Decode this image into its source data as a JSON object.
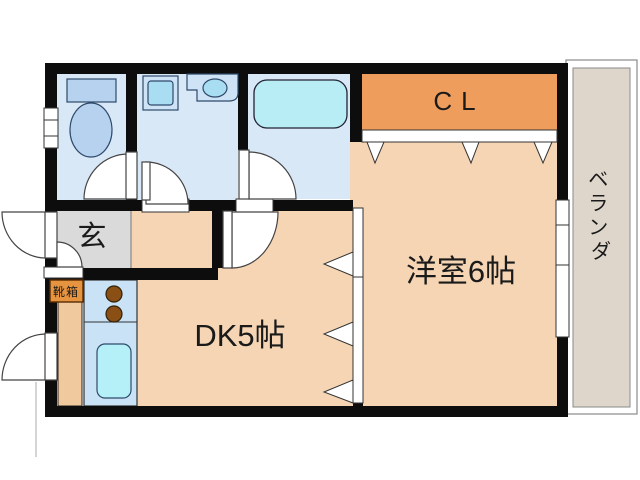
{
  "plan": {
    "type": "apartment-floor-plan",
    "rooms": {
      "entrance": {
        "label": "玄"
      },
      "shoe_box": {
        "label": "靴箱"
      },
      "dining_kitchen": {
        "label": "DK5帖"
      },
      "western_room": {
        "label": "洋室6帖"
      },
      "closet": {
        "label": "CL"
      },
      "balcony": {
        "label": "ベランダ",
        "chars": [
          "ベ",
          "ラ",
          "ン",
          "ダ"
        ]
      }
    },
    "fixtures": {
      "toilet": "toilet-icon",
      "bathtub": "bathtub-icon",
      "washer_pan": "washing-machine-pan-icon",
      "vanity_sink": "sink-icon",
      "stove": "stove-burners-icon",
      "kitchen_sink": "kitchen-sink-icon"
    },
    "colors": {
      "wall": "#0d0d0d",
      "wet_floor": "#d9e8f7",
      "fixture_blue": "#b7d2ee",
      "fixture_light": "#cfe3f6",
      "fixture_cyan": "#a9ddf2",
      "tub_cyan": "#b9edf6",
      "closet_orange": "#ef9d5c",
      "room_beige": "#f5d5b4",
      "entrance_gray": "#dadada",
      "balcony_tan": "#ded6ca",
      "kitchen_counter": "#c9e2f6",
      "kitchen_sink": "#b5f0f8",
      "stove_brown": "#8a4f14",
      "storage_tan": "#f1c99e",
      "shoebox_orange": "#e79440",
      "shoebox_text": "#3a1500",
      "text": "#1a1a1a"
    }
  }
}
